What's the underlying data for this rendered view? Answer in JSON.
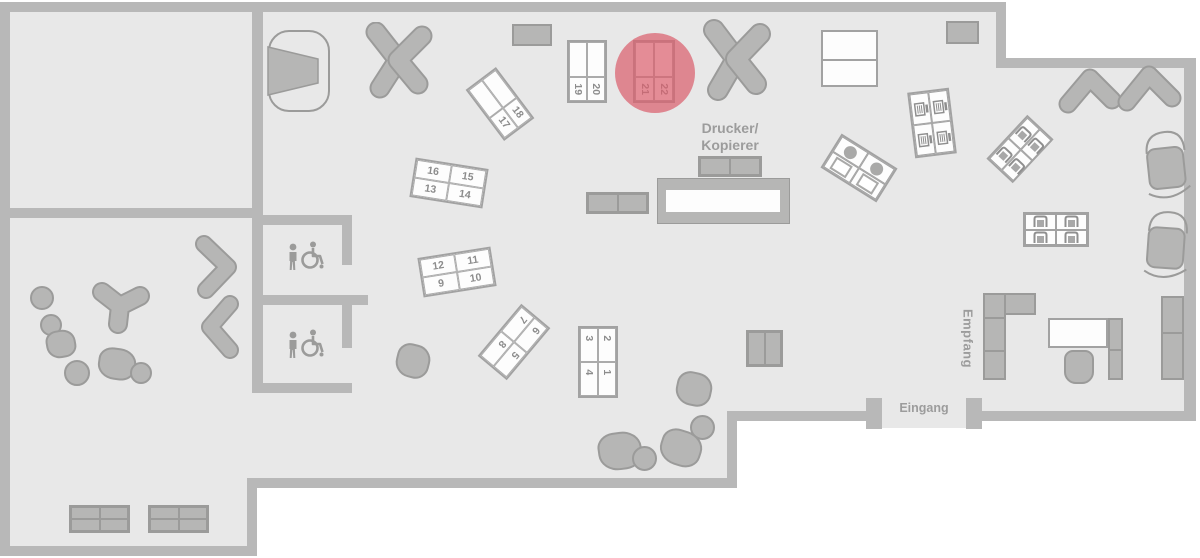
{
  "labels": {
    "printer_line1": "Drucker/",
    "printer_line2": "Kopierer",
    "reception": "Empfang",
    "entrance": "Eingang"
  },
  "desk_groups": {
    "g1_4": {
      "cells": [
        "3",
        "2",
        "4",
        "1"
      ]
    },
    "g5_8": {
      "cells": [
        "7",
        "6",
        "8",
        "5"
      ]
    },
    "g9_12": {
      "cells": [
        "12",
        "11",
        "9",
        "10"
      ]
    },
    "g13_16": {
      "cells": [
        "16",
        "15",
        "13",
        "14"
      ]
    },
    "g17_18": {
      "cells": [
        "17",
        "18"
      ]
    },
    "g19_20": {
      "cells": [
        "19",
        "20"
      ]
    },
    "g21_22": {
      "cells": [
        "21",
        "22"
      ]
    }
  },
  "highlight": {
    "desks": [
      "21",
      "22"
    ],
    "color": "rgba(217,95,110,0.72)"
  },
  "colors": {
    "floor": "#e8e8e8",
    "wall": "#b8b8b8",
    "furniture": "#b6b6b5",
    "desk_border": "#a2a2a2",
    "desk_number": "#8c8c8c",
    "label": "#9c9c9c",
    "highlight": "#d95f6e"
  },
  "icons": {
    "wc_person": "person-icon",
    "wc_accessible": "wheelchair-icon",
    "workstation": "workstation-icon",
    "armchair": "armchair-icon"
  }
}
